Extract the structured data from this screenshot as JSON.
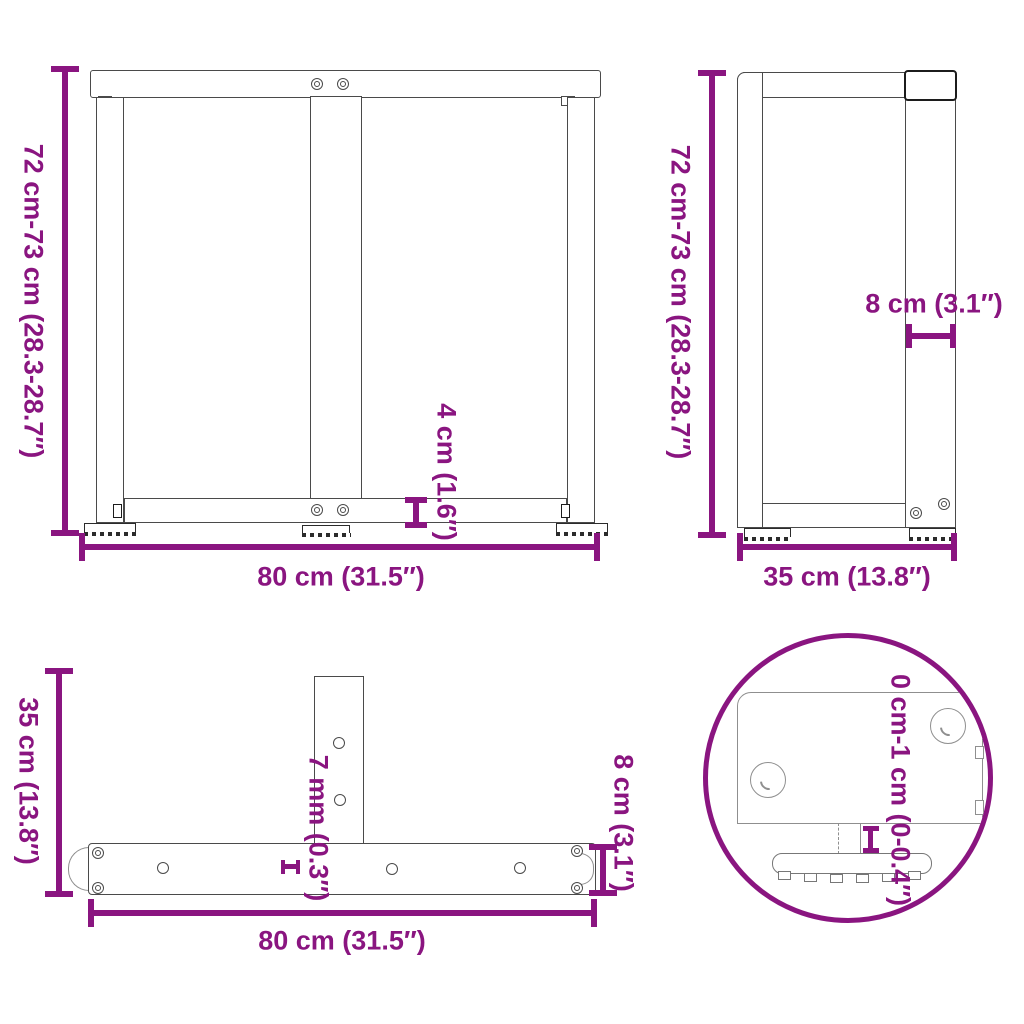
{
  "diagram_title": "table-leg-dimension-diagram",
  "colors": {
    "accent": "#8A1580",
    "drawing_line": "#4a4a4a",
    "background": "#ffffff"
  },
  "views": {
    "front": {
      "height_label": "72 cm-73 cm (28.3-28.7″)",
      "width_label": "80 cm (31.5″)",
      "rail_height_label": "4 cm (1.6″)"
    },
    "side": {
      "height_label": "72 cm-73 cm (28.3-28.7″)",
      "depth_label": "35 cm (13.8″)",
      "top_bar_label": "8 cm (3.1″)"
    },
    "top": {
      "depth_label": "35 cm (13.8″)",
      "width_label": "80 cm (31.5″)",
      "plate_thickness_label": "7 mm (0.3″)",
      "bar_width_label": "8 cm (3.1″)"
    },
    "detail": {
      "foot_adjust_label": "0 cm-1 cm (0-0.4″)"
    }
  }
}
